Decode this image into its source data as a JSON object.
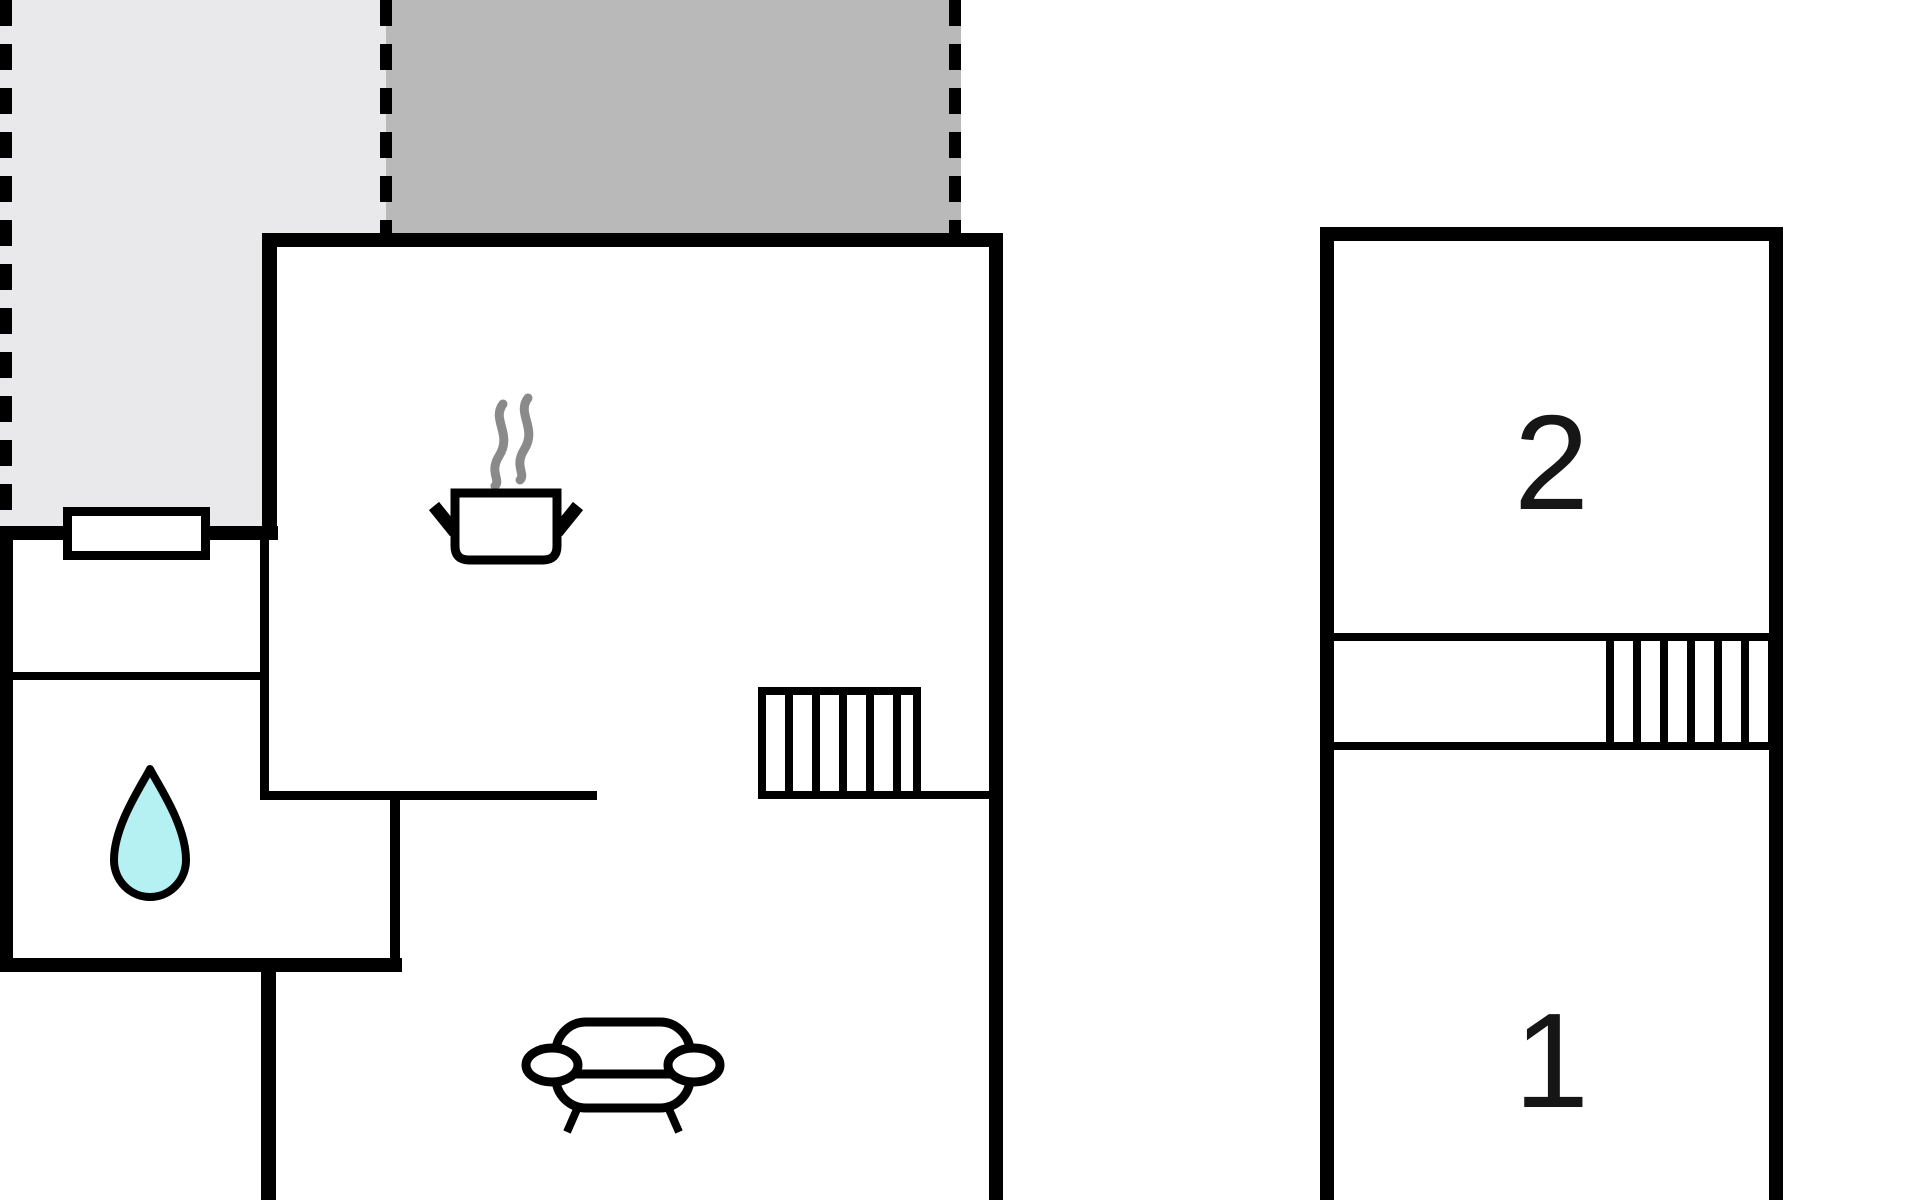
{
  "colors": {
    "background": "#ffffff",
    "wall": "#000000",
    "terrace_light": "#e9e9ec",
    "terrace_dark": "#b9b9b9",
    "water_drop_fill": "#b5f1f3",
    "steam": "#8a8a8a",
    "label_text": "#161616"
  },
  "annex": {
    "upper_room_label": "2",
    "lower_room_label": "1"
  },
  "icons": {
    "kitchen": "cooking-pot-icon",
    "bathroom": "water-drop-icon",
    "living_room": "sofa-icon",
    "main_stairs": "staircase",
    "annex_stairs": "staircase"
  }
}
